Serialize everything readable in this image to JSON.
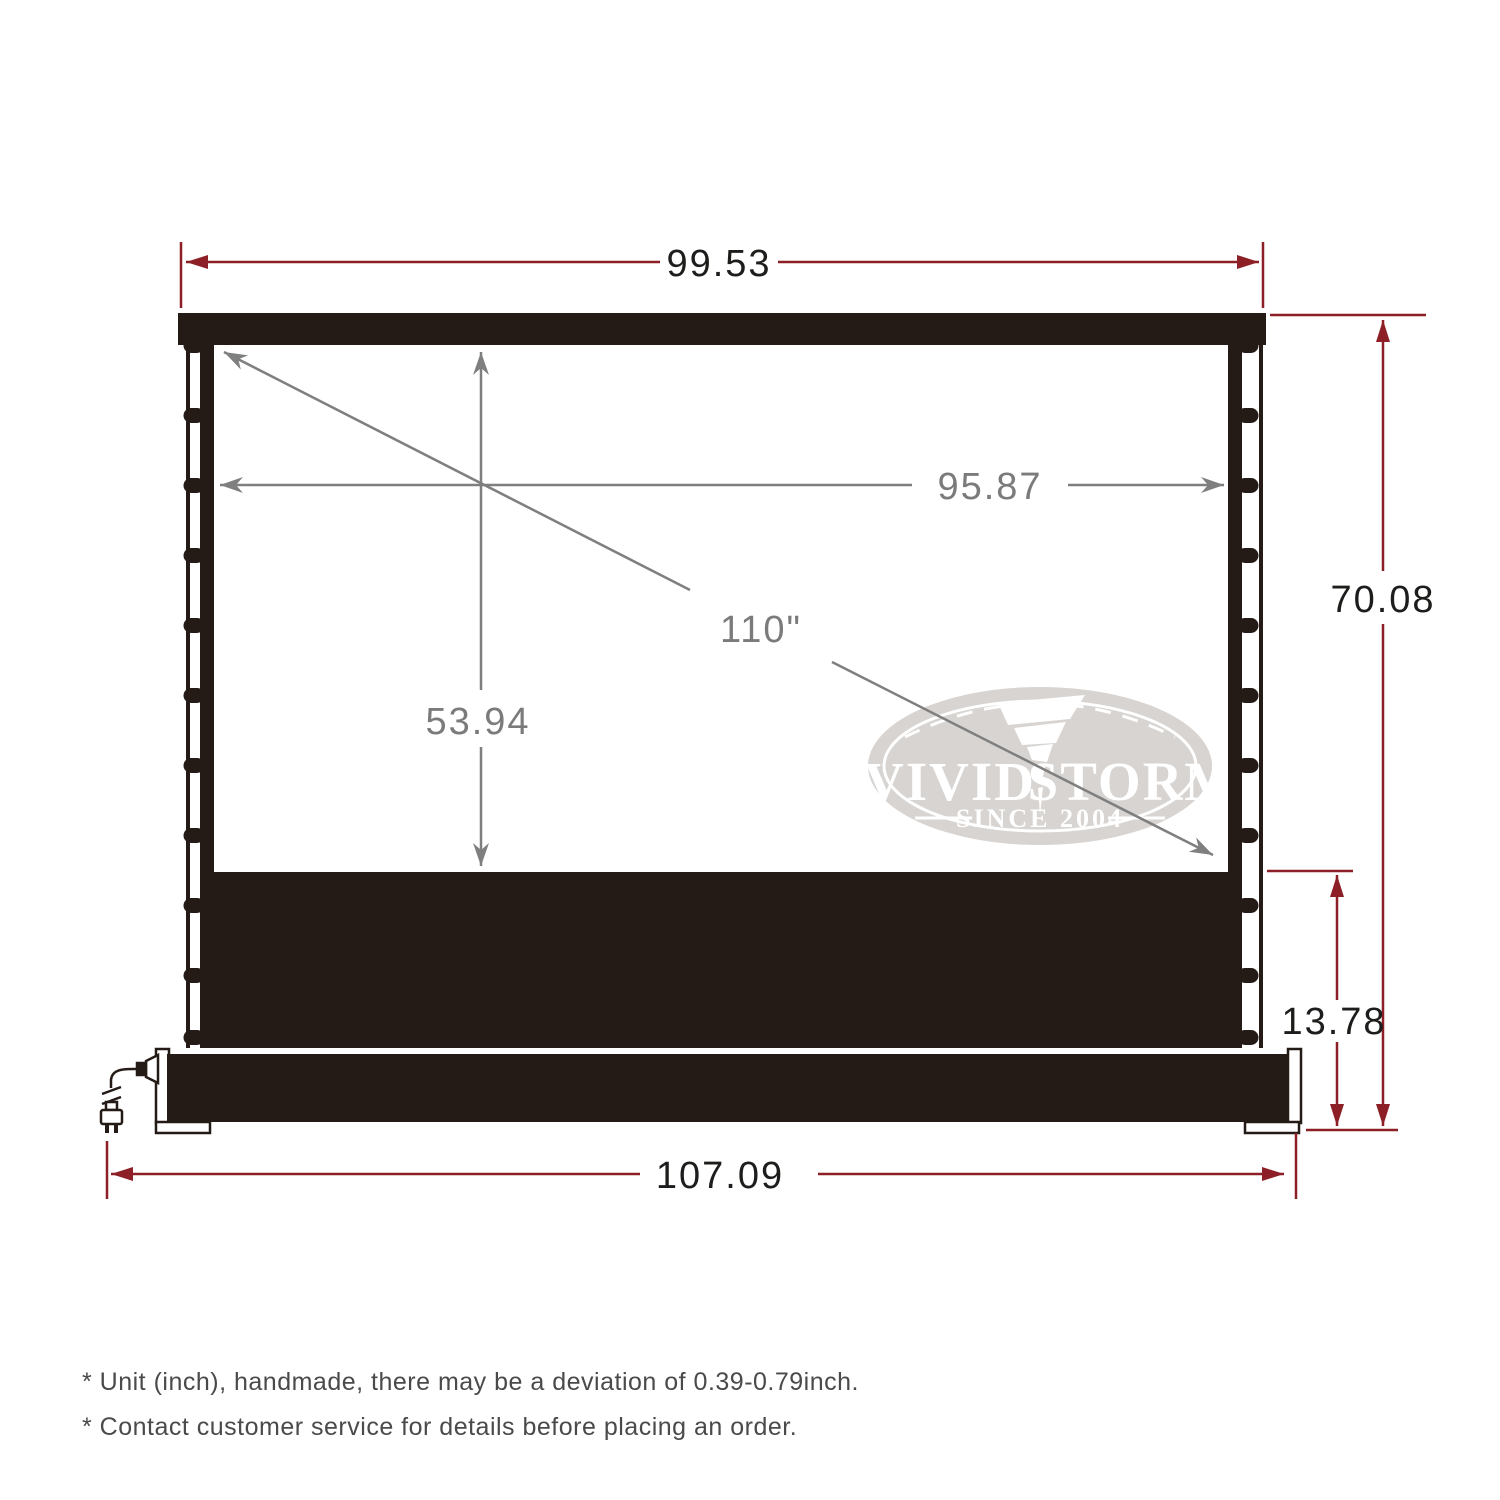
{
  "dimensions": {
    "top_width": "99.53",
    "viewing_width": "95.87",
    "diagonal": "110\"",
    "viewing_height": "53.94",
    "overall_height": "70.08",
    "base_section_height": "13.78",
    "base_width": "107.09"
  },
  "logo": {
    "name_left": "VIVID",
    "name_right": "STORM",
    "since": "SINCE 2004"
  },
  "footnotes": [
    "* Unit (inch), handmade, there may be a deviation of 0.39-0.79inch.",
    "* Contact customer service for details before placing an order."
  ],
  "colors": {
    "dimension_line_red": "#8d1f26",
    "inner_dimension_gray": "#7f7f7f",
    "screen_black": "#241a16",
    "logo_gray": "#d7d4d1",
    "footnote_gray": "#4a4a4a"
  }
}
